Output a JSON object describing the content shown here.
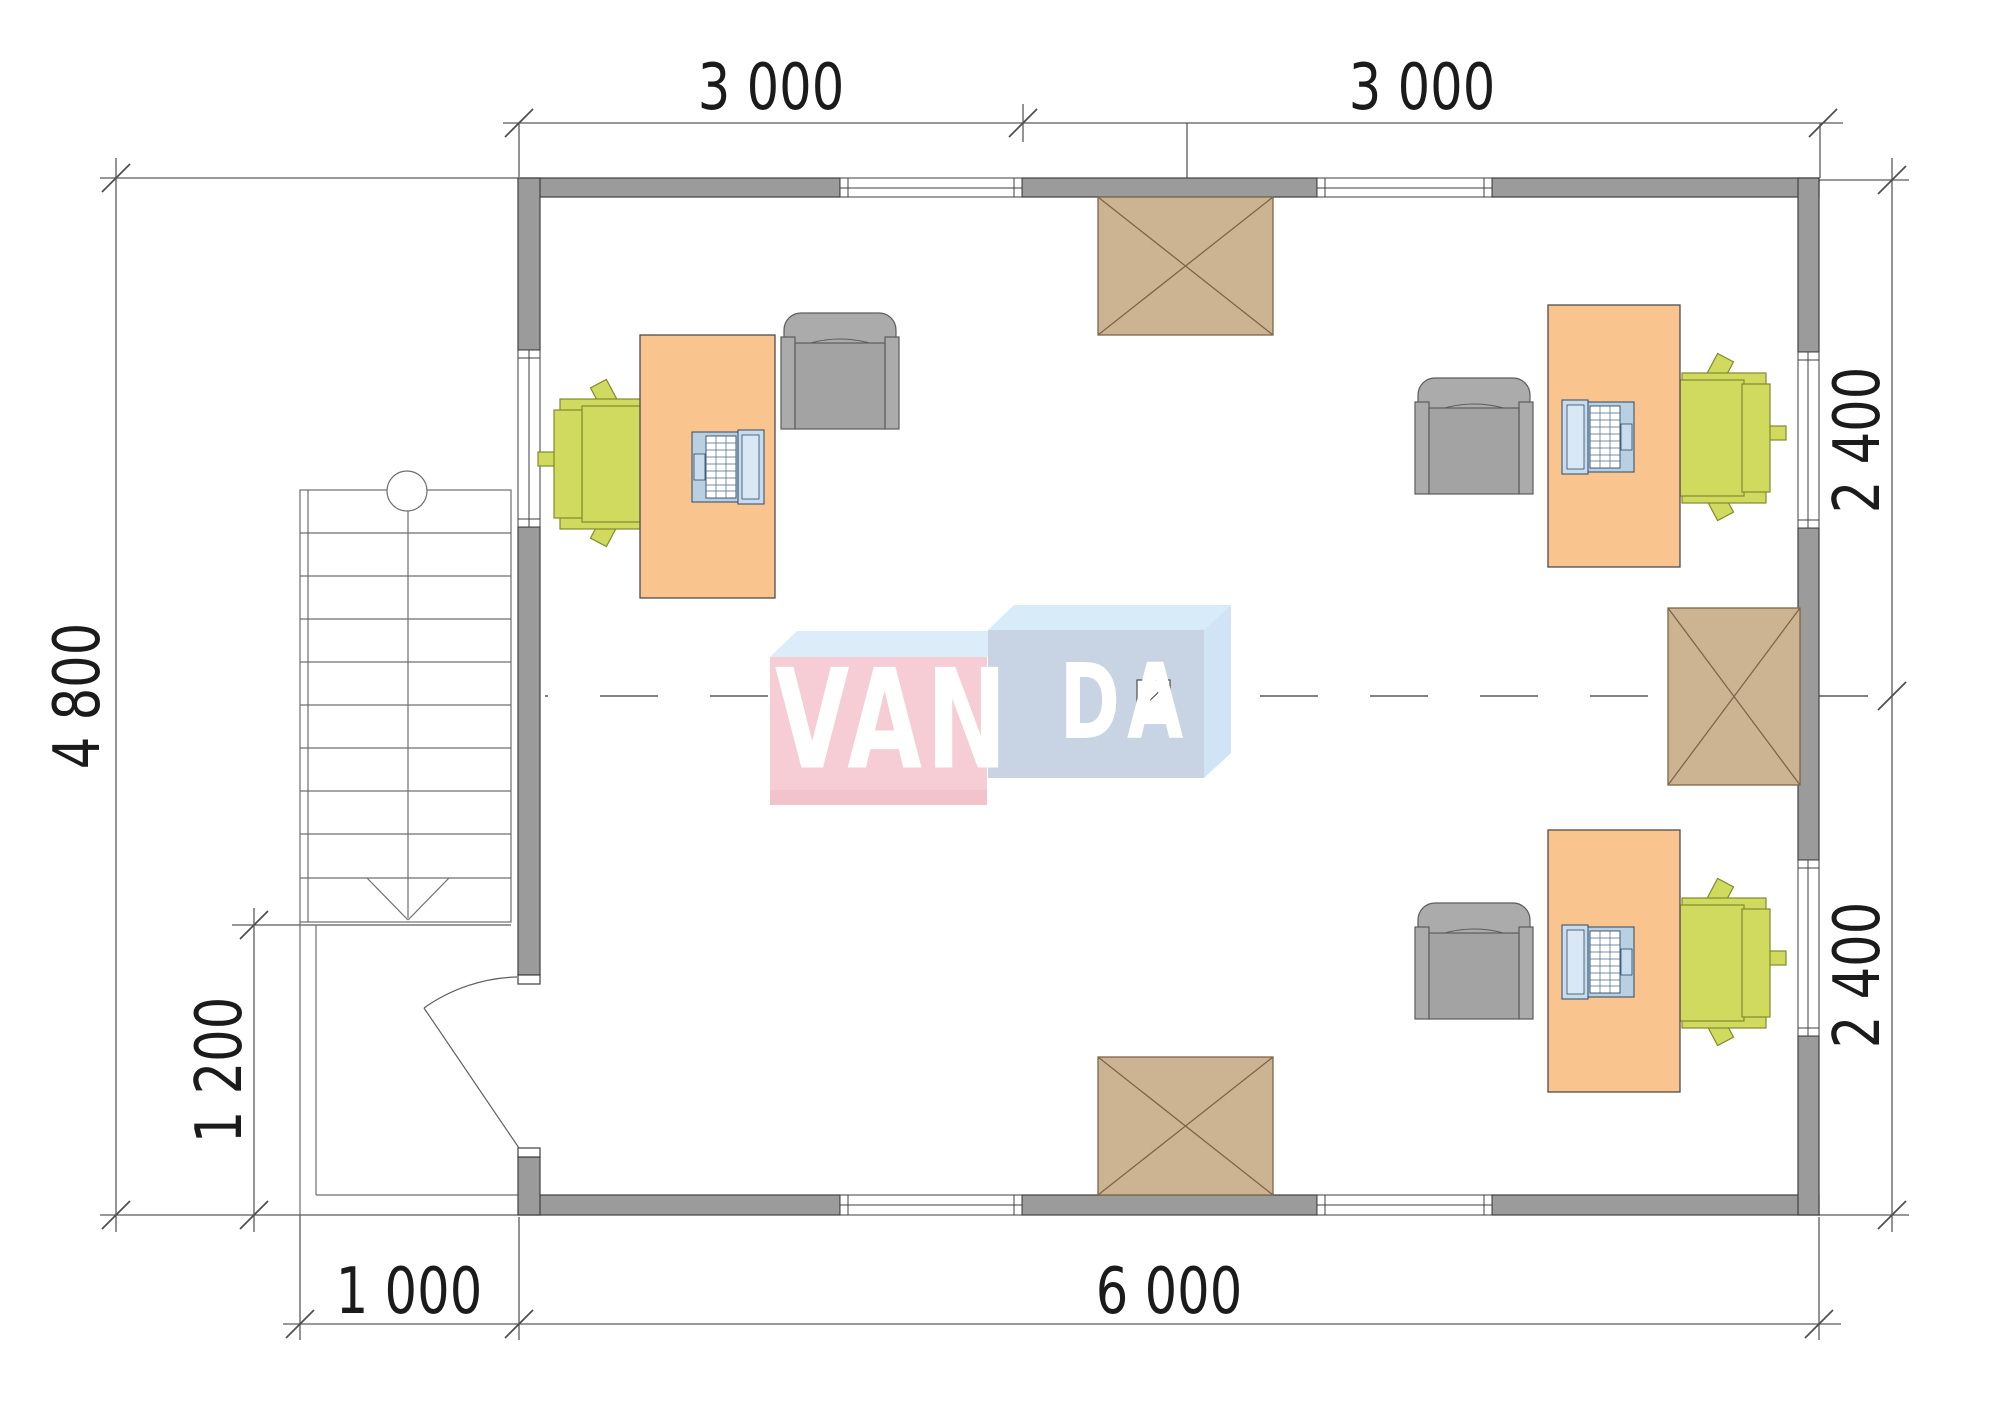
{
  "plan": {
    "type": "office-floor-plan",
    "watermark": {
      "brand": "VANDA",
      "van": "VAN",
      "da": "DA"
    },
    "dimensions": {
      "top": [
        {
          "label": "3 000"
        },
        {
          "label": "3 000"
        }
      ],
      "right": [
        {
          "label": "2 400"
        },
        {
          "label": "2 400"
        }
      ],
      "left": {
        "label": "4 800"
      },
      "stair_bay": {
        "label": "1 200"
      },
      "bottom": [
        {
          "label": "1 000"
        },
        {
          "label": "6 000"
        }
      ]
    },
    "colors": {
      "wall": "#9b9b9b",
      "wall_outline": "#3f3f3f",
      "dimension_line": "#5a5a5a",
      "text": "#1b1b1b",
      "desk": "#f9c48d",
      "chair_green": "#cfda5e",
      "chair_gray": "#ababab",
      "laptop": "#b9cfe2",
      "skylight": "#ccb391",
      "skylight_line": "#7d6648",
      "logo_pink": "#f6cdd4",
      "logo_blue_front": "#c8d4e3",
      "logo_blue_top": "#d7ebf9"
    }
  }
}
